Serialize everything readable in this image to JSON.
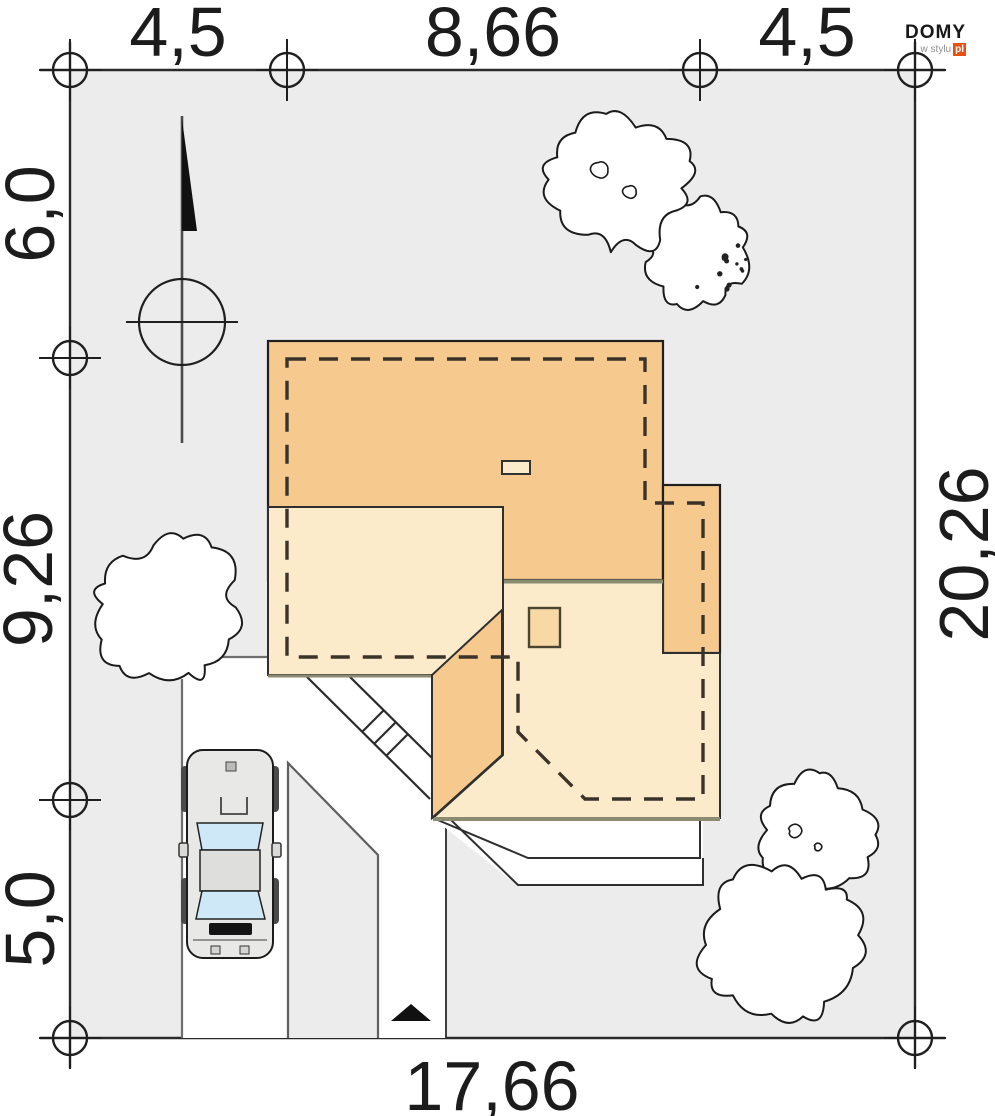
{
  "brand": {
    "name": "DOMY",
    "tagline": "w stylu",
    "tld": "pl",
    "accent_color": "#E8500F"
  },
  "dimensions": {
    "top": [
      {
        "label": "4,5"
      },
      {
        "label": "8,66"
      },
      {
        "label": "4,5"
      }
    ],
    "left": [
      {
        "label": "6,0"
      },
      {
        "label": "9,26"
      },
      {
        "label": "5,0"
      }
    ],
    "right": [
      {
        "label": "20,26"
      }
    ],
    "bottom": [
      {
        "label": "17,66"
      }
    ]
  },
  "plan_colors": {
    "plot_fill": "#ECECEC",
    "paving_fill": "#FFFFFF",
    "roof_primary": "#F6C98F",
    "roof_secondary": "#FBEBCA",
    "chimney_fill": "#F8D9A6",
    "eave_line": "#8B8B72",
    "glass_fill": "#CFE8F8",
    "outline": "#1f1f1f"
  }
}
